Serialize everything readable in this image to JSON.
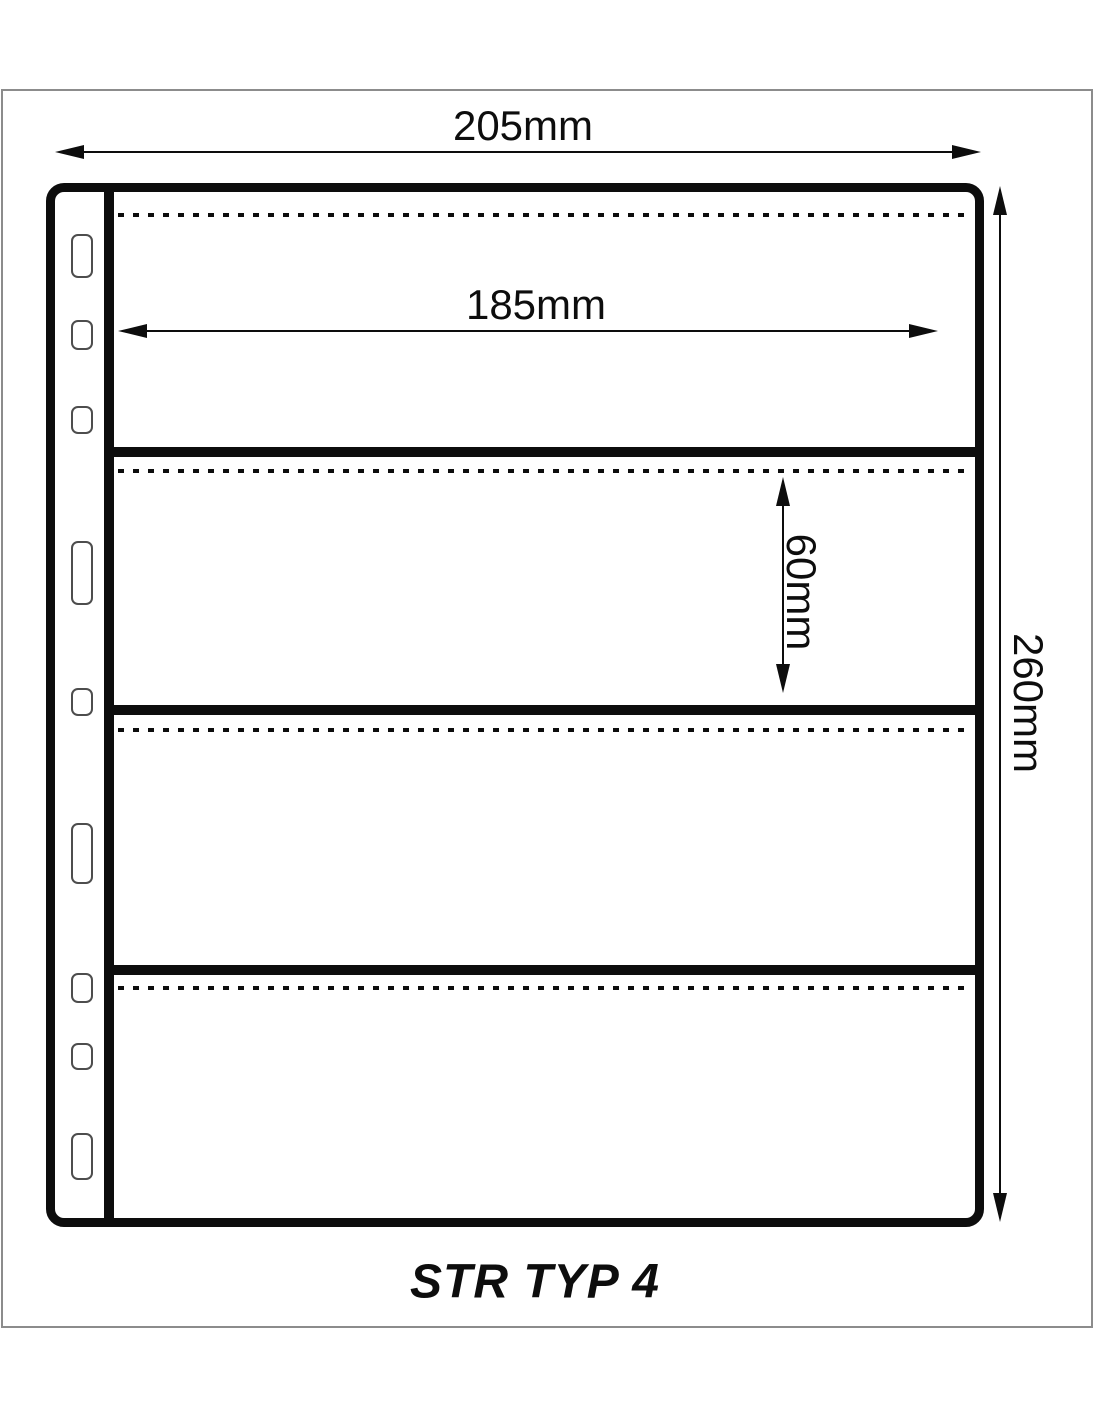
{
  "page": {
    "caption": "STR TYP 4",
    "description": "technical diagram of a 4-strip stock sheet with binder holes"
  },
  "dimensions": {
    "total_width": "205mm",
    "inner_width": "185mm",
    "strip_height": "60mm",
    "total_height": "260mm"
  },
  "sheet": {
    "strip_count": 4,
    "binding_hole_count": 9,
    "dotted_opening_count": 4
  },
  "colors": {
    "line": "#0d0d0d",
    "outer_frame": "#8c8c8c",
    "hole_outline": "#4d4d4d",
    "background": "#ffffff"
  }
}
